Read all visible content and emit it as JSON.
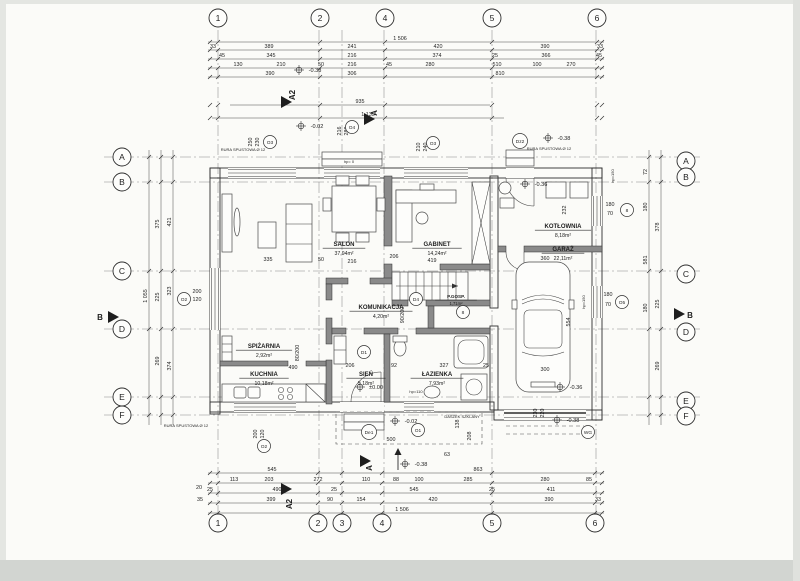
{
  "drawing": {
    "type": "floor plan (rzut parteru)",
    "paper_color": "#fbfbf8",
    "scan_edge_color": "#d8dad6",
    "line_color": "#2e2e2e"
  },
  "grid": {
    "top": [
      [
        "1",
        218
      ],
      [
        "2",
        320
      ],
      [
        "4",
        385
      ],
      [
        "5",
        492
      ],
      [
        "6",
        597
      ]
    ],
    "bottom": [
      [
        "1",
        218
      ],
      [
        "2",
        318
      ],
      [
        "3",
        342
      ],
      [
        "4",
        382
      ],
      [
        "5",
        492
      ],
      [
        "6",
        595
      ]
    ],
    "left": [
      [
        "A",
        157
      ],
      [
        "B",
        182
      ],
      [
        "C",
        271
      ],
      [
        "D",
        329
      ],
      [
        "E",
        397
      ],
      [
        "F",
        415
      ]
    ],
    "right": [
      [
        "A",
        161
      ],
      [
        "B",
        177
      ],
      [
        "C",
        274
      ],
      [
        "D",
        332
      ],
      [
        "E",
        401
      ],
      [
        "F",
        416
      ]
    ]
  },
  "rooms": [
    {
      "n": "03",
      "name": "SALON",
      "area": "37,94m²",
      "floor": "panele",
      "x": 344,
      "y": 246
    },
    {
      "n": "06",
      "name": "GABINET",
      "area": "14,24m²",
      "floor": "panele",
      "x": 437,
      "y": 246
    },
    {
      "n": "02",
      "name": "KOMUNIKACJA",
      "area": "4,20m²",
      "floor": "panele",
      "x": 381,
      "y": 309
    },
    {
      "n": "01",
      "name": "SIEŃ",
      "area": "5,18m²",
      "floor": "terakota",
      "x": 366,
      "y": 376
    },
    {
      "n": "04",
      "name": "KUCHNIA",
      "area": "10,18m²",
      "floor": "terakota",
      "x": 264,
      "y": 376
    },
    {
      "n": "05",
      "name": "SPIŻARNIA",
      "area": "2,92m²",
      "floor": "panele",
      "x": 264,
      "y": 348
    },
    {
      "n": "07",
      "name": "ŁAZIENKA",
      "area": "7,93m²",
      "floor": "terakota",
      "x": 437,
      "y": 376
    },
    {
      "n": "08",
      "name": "P.GOSP.",
      "area": "1,71m²",
      "floor": "terakota",
      "x": 456,
      "y": 298,
      "small": true
    },
    {
      "n": "09",
      "name": "KOTŁOWNIA",
      "area": "8,18m²",
      "floor": "terakota",
      "x": 563,
      "y": 228
    },
    {
      "n": "10",
      "name": "GARAŻ",
      "area": "22,11m²",
      "floor": "terakota",
      "x": 563,
      "y": 251
    }
  ],
  "dims": [
    [
      "1 506",
      400,
      40
    ],
    [
      "33",
      213,
      48
    ],
    [
      "389",
      269,
      48
    ],
    [
      "241",
      352,
      48
    ],
    [
      "420",
      438,
      48
    ],
    [
      "390",
      545,
      48
    ],
    [
      "33",
      600,
      48
    ],
    [
      "45",
      222,
      57
    ],
    [
      "345",
      271,
      57
    ],
    [
      "216",
      352,
      57
    ],
    [
      "374",
      437,
      57
    ],
    [
      "25",
      495,
      57
    ],
    [
      "366",
      546,
      57
    ],
    [
      "45",
      599,
      57
    ],
    [
      "130",
      238,
      66
    ],
    [
      "210",
      281,
      66
    ],
    [
      "50",
      321,
      66
    ],
    [
      "216",
      352,
      66
    ],
    [
      "45",
      389,
      66
    ],
    [
      "280",
      430,
      66
    ],
    [
      "510",
      497,
      66
    ],
    [
      "100",
      537,
      66
    ],
    [
      "270",
      571,
      66
    ],
    [
      "390",
      270,
      75
    ],
    [
      "306",
      352,
      75
    ],
    [
      "810",
      500,
      75
    ],
    [
      "935",
      360,
      103
    ],
    [
      "1 135",
      368,
      116
    ],
    [
      "545",
      272,
      471
    ],
    [
      "863",
      478,
      471
    ],
    [
      "113",
      234,
      481
    ],
    [
      "203",
      269,
      481
    ],
    [
      "272",
      318,
      481
    ],
    [
      "110",
      366,
      481
    ],
    [
      "88",
      396,
      481
    ],
    [
      "100",
      419,
      481
    ],
    [
      "285",
      468,
      481
    ],
    [
      "280",
      545,
      481
    ],
    [
      "85",
      589,
      481
    ],
    [
      "20",
      199,
      489
    ],
    [
      "25",
      210,
      491
    ],
    [
      "490",
      277,
      491
    ],
    [
      "25",
      334,
      491
    ],
    [
      "545",
      414,
      491
    ],
    [
      "25",
      492,
      491
    ],
    [
      "411",
      551,
      491
    ],
    [
      "35",
      200,
      501
    ],
    [
      "399",
      271,
      501
    ],
    [
      "90",
      330,
      501
    ],
    [
      "154",
      361,
      501
    ],
    [
      "420",
      433,
      501
    ],
    [
      "390",
      549,
      501
    ],
    [
      "33",
      598,
      501
    ],
    [
      "1 506",
      402,
      511
    ],
    [
      "1 055",
      147,
      296,
      1
    ],
    [
      "375",
      159,
      224,
      1
    ],
    [
      "225",
      159,
      297,
      1
    ],
    [
      "269",
      159,
      361,
      1
    ],
    [
      "421",
      171,
      222,
      1
    ],
    [
      "323",
      171,
      291,
      1
    ],
    [
      "374",
      171,
      366,
      1
    ],
    [
      "72",
      647,
      172,
      1
    ],
    [
      "180",
      647,
      207,
      1
    ],
    [
      "581",
      647,
      260,
      1
    ],
    [
      "180",
      647,
      308,
      1
    ],
    [
      "378",
      659,
      227,
      1
    ],
    [
      "225",
      659,
      304,
      1
    ],
    [
      "269",
      659,
      366,
      1
    ],
    [
      "335",
      268,
      261
    ],
    [
      "50",
      321,
      261
    ],
    [
      "216",
      352,
      263
    ],
    [
      "206",
      394,
      258
    ],
    [
      "419",
      432,
      262
    ],
    [
      "360",
      545,
      260
    ],
    [
      "554",
      570,
      322,
      1
    ],
    [
      "300",
      545,
      371
    ],
    [
      "490",
      293,
      369
    ],
    [
      "206",
      350,
      367
    ],
    [
      "92",
      394,
      367
    ],
    [
      "327",
      444,
      367
    ],
    [
      "25",
      486,
      367
    ],
    [
      "500",
      391,
      441
    ],
    [
      "138",
      459,
      424,
      1
    ],
    [
      "208",
      471,
      436,
      1
    ],
    [
      "63",
      447,
      456
    ],
    [
      "230",
      537,
      413,
      1
    ],
    [
      "220",
      544,
      413,
      1
    ],
    [
      "232",
      566,
      210,
      1
    ],
    [
      "250",
      252,
      142,
      1
    ],
    [
      "230",
      259,
      142,
      1
    ],
    [
      "216",
      341,
      131,
      1
    ],
    [
      "280",
      348,
      131,
      1
    ],
    [
      "210",
      420,
      147,
      1
    ],
    [
      "240",
      427,
      147,
      1
    ],
    [
      "200",
      197,
      293
    ],
    [
      "120",
      197,
      301
    ],
    [
      "200",
      257,
      434,
      1
    ],
    [
      "120",
      264,
      434,
      1
    ],
    [
      "180",
      610,
      206
    ],
    [
      "70",
      610,
      215
    ],
    [
      "180",
      608,
      296
    ],
    [
      "70",
      608,
      306
    ],
    [
      "80/200",
      299,
      353,
      1
    ],
    [
      "90/200",
      404,
      315,
      1
    ]
  ],
  "levels": [
    [
      "-0.38",
      307,
      72
    ],
    [
      "-0.02",
      309,
      128
    ],
    [
      "-0.38",
      556,
      140
    ],
    [
      "-0.36",
      533,
      186
    ],
    [
      "±0.00",
      368,
      389
    ],
    [
      "-0.02",
      403,
      423
    ],
    [
      "-0.38",
      413,
      466
    ],
    [
      "-0.36",
      568,
      389
    ],
    [
      "-0.38",
      565,
      422
    ]
  ],
  "markers": [
    [
      "O3",
      270,
      142
    ],
    [
      "O4",
      352,
      127
    ],
    [
      "O3",
      433,
      143
    ],
    [
      "Dz2",
      520,
      141
    ],
    [
      "O2",
      184,
      299
    ],
    [
      "O2",
      264,
      446
    ],
    [
      "O1",
      418,
      430
    ],
    [
      "O5",
      622,
      302
    ],
    [
      "8",
      627,
      210
    ],
    [
      "8",
      463,
      312
    ],
    [
      "D1",
      364,
      352
    ],
    [
      "D4",
      416,
      299
    ],
    [
      "De1",
      369,
      432
    ],
    [
      "WG",
      588,
      432
    ]
  ],
  "notes": [
    [
      "RURA SPUSTOWA Ø 12",
      243,
      151
    ],
    [
      "RURA SPUSTOWA Ø 12",
      549,
      150
    ],
    [
      "RURA SPUSTOWA Ø 12",
      186,
      427
    ],
    [
      "DASZEK SZKLANY",
      462,
      418
    ],
    [
      "hp= 0",
      349,
      163
    ],
    [
      "hp=110",
      416,
      393
    ],
    [
      "hp=150",
      585,
      302,
      1
    ],
    [
      "hp=150",
      614,
      176,
      1
    ]
  ],
  "sections": [
    {
      "l": "A2",
      "tx": 281,
      "ty": 102,
      "lx": 295,
      "ly": 95,
      "rot": 1
    },
    {
      "l": "A2",
      "tx": 281,
      "ty": 489,
      "lx": 292,
      "ly": 504,
      "rot": 1
    },
    {
      "l": "A",
      "tx": 364,
      "ty": 119,
      "lx": 377,
      "ly": 113,
      "rot": 1
    },
    {
      "l": "A",
      "tx": 360,
      "ty": 461,
      "lx": 372,
      "ly": 468,
      "rot": 1
    },
    {
      "l": "B",
      "tx": 108,
      "ty": 317,
      "lx": 100,
      "ly": 320,
      "rot": 0
    },
    {
      "l": "B",
      "tx": 674,
      "ty": 314,
      "lx": 690,
      "ly": 318,
      "rot": 0
    }
  ]
}
